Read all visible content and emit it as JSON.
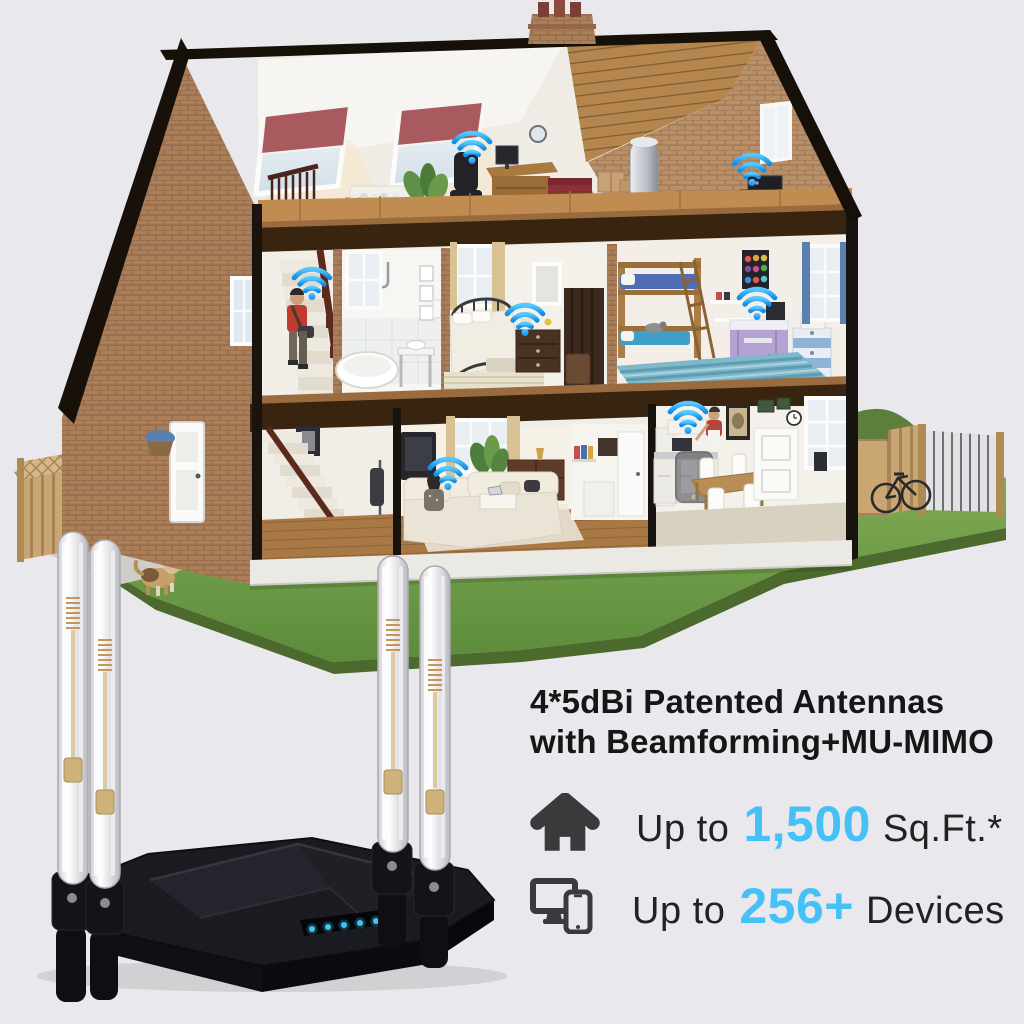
{
  "page": {
    "background_color": "#e9e9ed"
  },
  "headline": {
    "line1": "4*5dBi Patented Antennas",
    "line2": "with Beamforming+MU-MIMO"
  },
  "stats": [
    {
      "icon": "house-icon",
      "prefix": "Up to",
      "value": "1,500",
      "suffix": "Sq.Ft.*"
    },
    {
      "icon": "devices-icon",
      "prefix": "Up to",
      "value": "256+",
      "suffix": "Devices"
    }
  ],
  "colors": {
    "accent_blue": "#45c1f8",
    "headline_text": "#161616",
    "body_text": "#222222",
    "stat_icon": "#3a3a3c",
    "wifi_signal": "#2ba7f0",
    "router_body": "#17181d",
    "led_blue": "#41c4f2"
  },
  "scene": {
    "wifi_markers": 7,
    "router_antennas": 4,
    "router_leds": 6,
    "rooms": [
      "attic-office",
      "attic-storage",
      "staircase",
      "bathroom",
      "bedroom",
      "kids-room",
      "hallway",
      "living-room",
      "kitchen-dining",
      "front-yard",
      "patio",
      "back-garden"
    ]
  }
}
